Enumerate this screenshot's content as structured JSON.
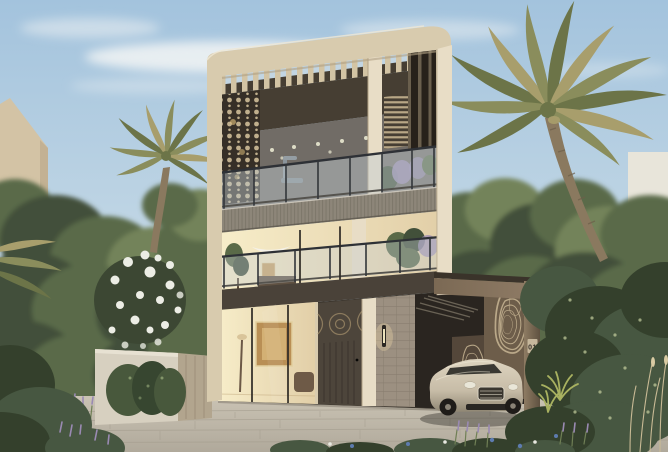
{
  "meta": {
    "type": "architectural-exterior-rendering",
    "description": "Daytime photorealistic rendering of a modern three-storey luxury villa with a cream curved frame, wooden pergola slats, glass balconies, a bronze carport with topographic-pattern feature wall, a champagne luxury sedan, palm trees and a landscaped stone driveway."
  },
  "texts": {
    "villa_number": "01"
  },
  "palette": {
    "sky_top": "#a3c3dd",
    "sky_mid": "#c2d7e5",
    "sky_horizon": "#dce4e8",
    "cloud": "#f2f4f4",
    "left_building": "#d3c3a5",
    "left_building_shade": "#bfae8f",
    "right_building": "#e8e5da",
    "right_building_window": "#55534a",
    "tree_dark": "#42503a",
    "tree_mid": "#5a6a48",
    "tree_light": "#73835a",
    "bush_dark": "#34402c",
    "bush_mid": "#475741",
    "bush_speckle": "#c6cf9f",
    "palm_frond_dark": "#6c7448",
    "palm_frond_mid": "#8a8d5c",
    "palm_frond_light": "#a89e6c",
    "palm_trunk": "#8a795f",
    "palm_trunk_dark": "#6d5f4a",
    "frame_cream": "#d8cbae",
    "frame_cream_light": "#e8ddc6",
    "frame_shadow": "#b1a184",
    "slat_cream": "#d3c4a4",
    "slat_sky": "#c2d5e2",
    "band_dark": "#463e33",
    "interior_dark": "#57493c",
    "glass_blue": "#a8b7c0",
    "glass_rail": "#c4ced3",
    "rail_frame": "#2e3136",
    "interior_warm": "#e2cfa8",
    "interior_glow": "#f7edc9",
    "fascia_grey": "#8d8679",
    "fascia_rib": "#6f6a5e",
    "slab_dark": "#4a4239",
    "screen_dark": "#362f27",
    "screen_dot": "#cfbd98",
    "louver_light": "#c5b38f",
    "fin_dark": "#27211a",
    "fin_back": "#6a5f4d",
    "door_dark": "#4d453b",
    "door_trim": "#8c7b5e",
    "tile_wall": "#9c9081",
    "tile_line": "#83796a",
    "sconce_glow": "#f2deac",
    "carport_lid": "#3a332a",
    "carport_fascia": "#7b6954",
    "carport_fascia_light": "#94806a",
    "carport_shadow": "#2a2520",
    "ceiling_slat": "#b7ac95",
    "pattern_wall": "#6d5d4a",
    "pattern_wall_dark": "#54473a",
    "contour_line": "#c8b694",
    "pillar_bronze": "#8e7c63",
    "plaque_bg": "#c6b79c",
    "plaque_text": "#39322b",
    "car_body": "#c7bca7",
    "car_body_light": "#ded4c0",
    "car_window": "#2d2b27",
    "car_chrome": "#d8d1c1",
    "car_dark": "#292623",
    "car_tire": "#1f1c19",
    "wheel_hub": "#8a8376",
    "pavement": "#cac3b4",
    "pavement_dark": "#b0a99b",
    "pavement_shade": "#8d8678",
    "garden_wall": "#d7d0c0",
    "gate_wood": "#b2a58e",
    "hedge": "#48583c",
    "blossom_white": "#ecede5",
    "lavender": "#9a8ab3",
    "flower_blue": "#5d7baf",
    "grass_tan": "#c8ba95",
    "fern_bright": "#a8b160"
  },
  "scene": {
    "objects": [
      "sky",
      "clouds",
      "neighboring-building-left",
      "neighboring-building-right",
      "background-trees",
      "palm-trees",
      "villa",
      "pergola-roof-slats",
      "mashrabiya-screen",
      "glass-balconies",
      "entry-door",
      "wall-sconce",
      "carport",
      "topographic-feature-wall",
      "villa-number-plaque",
      "luxury-sedan",
      "stone-driveway",
      "garden-wall",
      "hedge",
      "flowering-tree",
      "lavender-plants",
      "foreground-flowers"
    ]
  }
}
